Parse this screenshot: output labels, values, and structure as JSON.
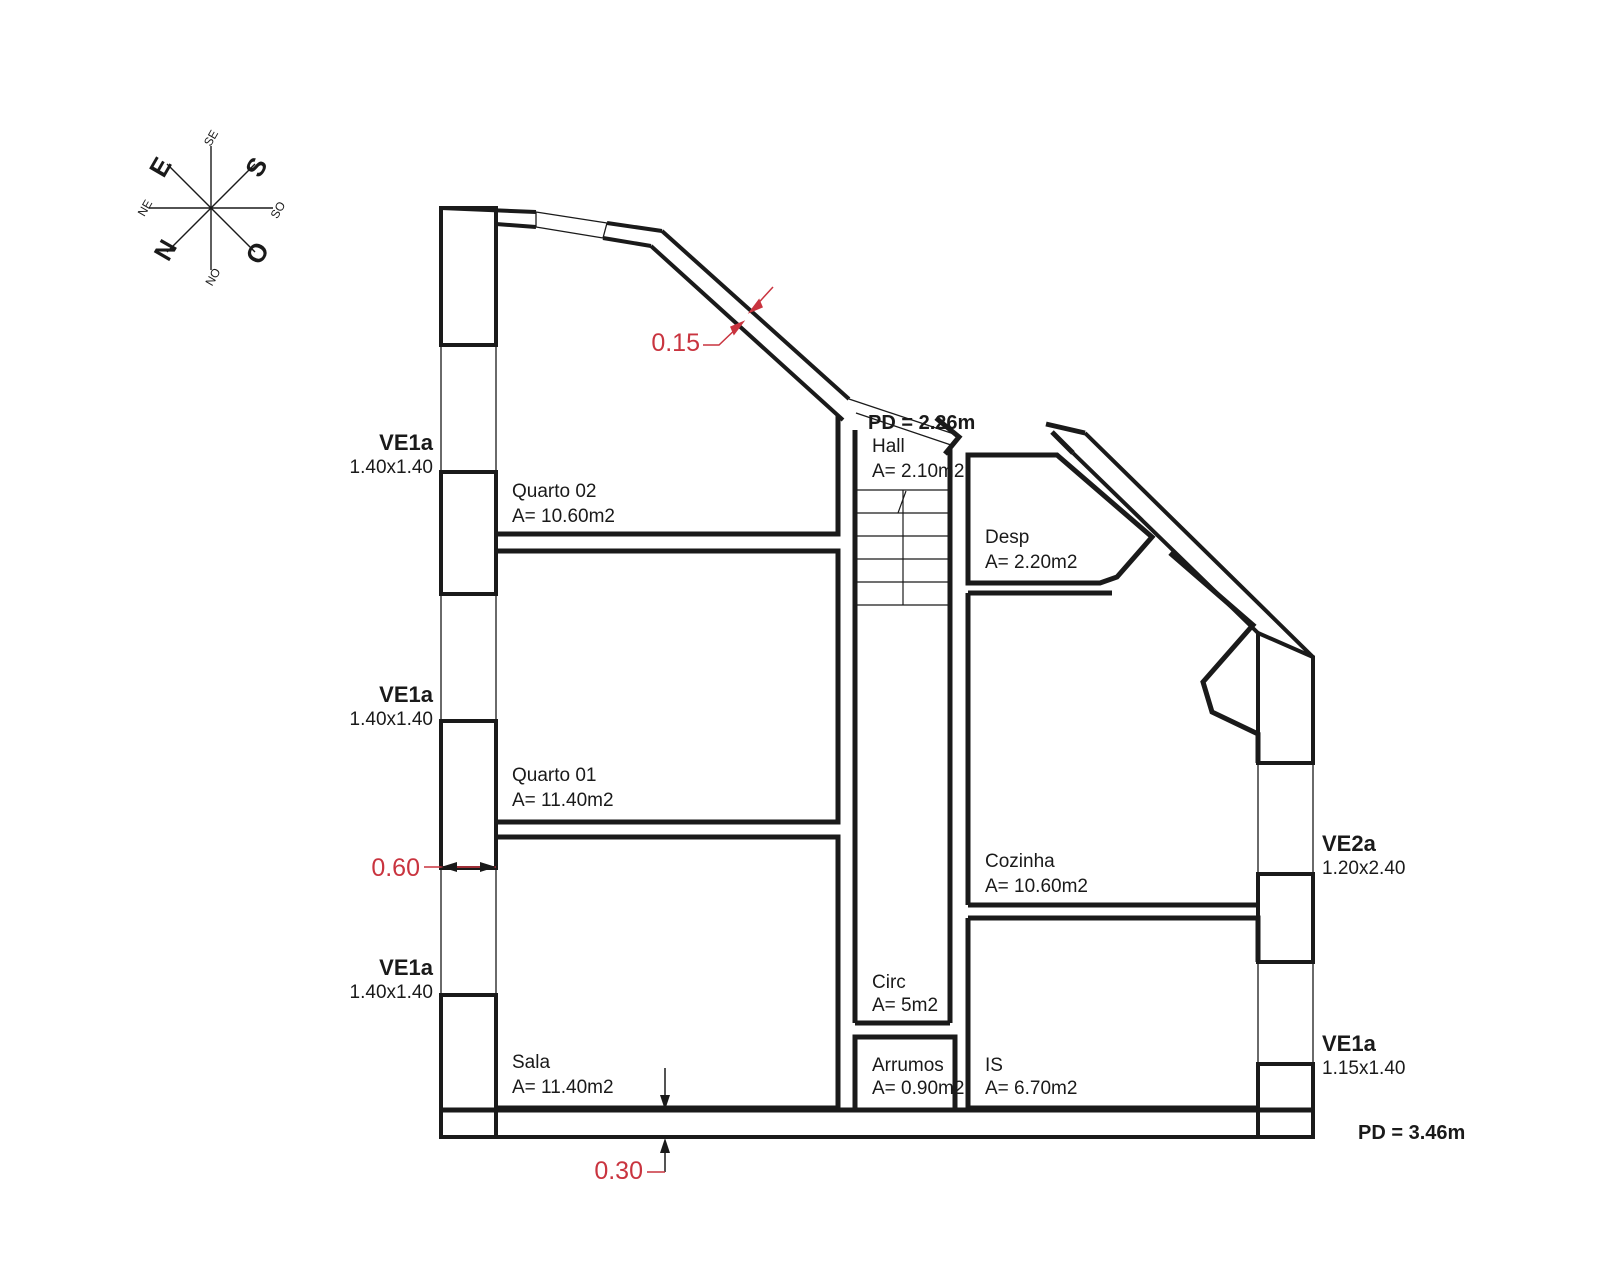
{
  "title": "Floor plan",
  "colors": {
    "line": "#1a1a1a",
    "dimension": "#c9343f",
    "background": "#ffffff"
  },
  "compass": {
    "n": "N",
    "s": "S",
    "e": "E",
    "o": "O",
    "ne": "NE",
    "se": "SE",
    "so": "SO",
    "no": "NO"
  },
  "rooms": {
    "quarto02": {
      "name": "Quarto 02",
      "area": "A= 10.60m2"
    },
    "quarto01": {
      "name": "Quarto 01",
      "area": "A= 11.40m2"
    },
    "sala": {
      "name": "Sala",
      "area": "A= 11.40m2"
    },
    "hall": {
      "name": "Hall",
      "area": "A= 2.10m2"
    },
    "circ": {
      "name": "Circ",
      "area": "A= 5m2"
    },
    "arrumos": {
      "name": "Arrumos",
      "area": "A= 0.90m2"
    },
    "desp": {
      "name": "Desp",
      "area": "A= 2.20m2"
    },
    "cozinha": {
      "name": "Cozinha",
      "area": "A= 10.60m2"
    },
    "is": {
      "name": "IS",
      "area": "A= 6.70m2"
    }
  },
  "windows": {
    "left1": {
      "code": "VE1a",
      "size": "1.40x1.40"
    },
    "left2": {
      "code": "VE1a",
      "size": "1.40x1.40"
    },
    "left3": {
      "code": "VE1a",
      "size": "1.40x1.40"
    },
    "right1": {
      "code": "VE2a",
      "size": "1.20x2.40"
    },
    "right2": {
      "code": "VE1a",
      "size": "1.15x1.40"
    }
  },
  "ceiling_heights": {
    "upper": "PD = 2.26m",
    "lower": "PD = 3.46m"
  },
  "dimensions": {
    "wall_diagonal": "0.15",
    "wall_left": "0.60",
    "wall_bottom": "0.30"
  }
}
